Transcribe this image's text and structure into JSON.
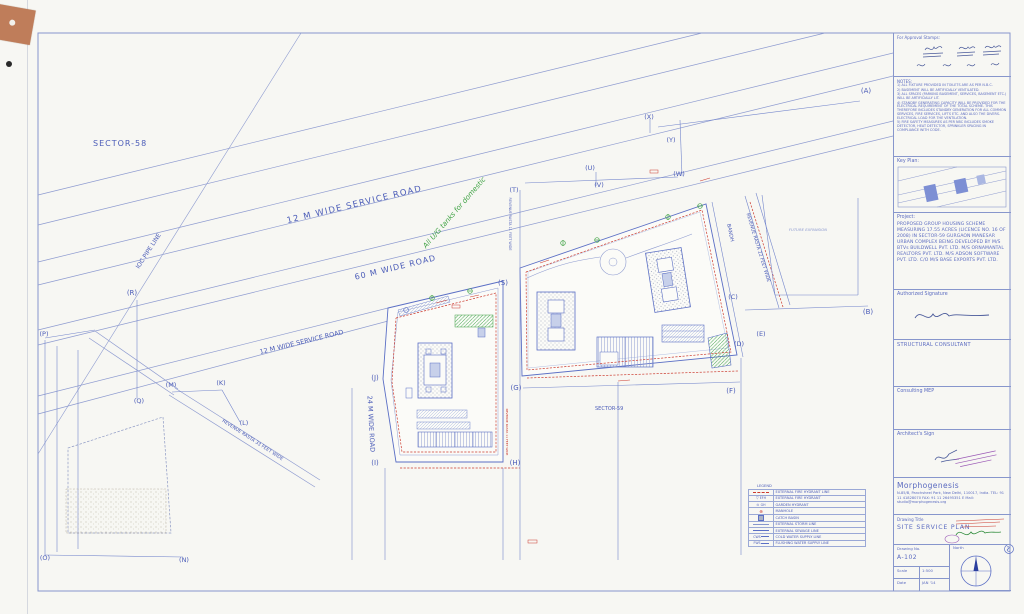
{
  "title_block": {
    "approval_label": "For Approval Stamps:",
    "notes": {
      "heading": "NOTES:",
      "items": [
        "1)  ALL FIXTURE PROVIDED IN TOILETS ARE AS PER N.B.C.",
        "2)  BASEMENT WILL BE ARTIFICIALLY VENTILATED.",
        "3)  ALL SPACES (PARKING BASEMENT, SERVICES, BASEMENT ETC.) WILL BE ARTIFICIALLY LIT.",
        "4)  STANDBY GENERATING CAPACITY WILL BE PROVIDED FOR THE ELECTRICAL REQUIREMENT OF THE TOTAL SCHEME. THIS THEREFORE INCLUDES STANDBY GENERATION FOR ALL COMMON SERVICES, FIRE SERVICES, LIFTS ETC. AND ALSO THE DIVERS. ELECTRICAL LOAD FOR THE VENTILATION.",
        "5)  FIRE SAFETY MEASURES AS PER NBC INCLUDES SMOKE DETECTOR, HEAT DETECTOR, SPRINKLER SPACING IN COMPLIANCE WITH CODE."
      ]
    },
    "key_plan_label": "Key Plan:",
    "project_heading": "Project:",
    "project_text": "PROPOSED GROUP HOUSING SCHEME MEASURING 17.55 ACRES (LICENCE NO. 16 OF 2008) IN SECTOR-59 GURGAON MANESAR URBAN COMPLEX BEING DEVELOPED BY M/S BTVs BUILDWELL PVT. LTD. M/S ORNAMANTAL REALTORS PVT. LTD. M/S ADSON SOFTWARE PVT. LTD. C/O M/S BASE EXPORTS PVT. LTD.",
    "authorized_signature_label": "Authorized Signature",
    "structural_consultant_label": "STRUCTURAL CONSULTANT",
    "consulting_mep_label": "Consulting MEP",
    "architects_sign_label": "Architect's Sign",
    "firm_name": "Morphogenesis",
    "firm_address": "N-85/B, Panchsheel Park, New Delhi, 110017, India. TEL: 91 11 41828070  FAX: 91 11 26495351  E Mail: studio@morphogenesis.org",
    "drawing_title_label": "Drawing Title",
    "drawing_title": "SITE SERVICE PLAN",
    "drawing_no_label": "Drawing No.",
    "drawing_no": "A-102",
    "north_label": "North",
    "scale_label": "Scale",
    "scale_value": "1:500",
    "date_label": "Date",
    "date_value": "JAN '14"
  },
  "legend": {
    "title": "LEGEND",
    "rows": [
      {
        "sym": "",
        "label": "EXTERNAL FIRE HYDRANT LINE"
      },
      {
        "sym": "EFH",
        "label": "EXTERNAL FIRE HYDRANT"
      },
      {
        "sym": "GH",
        "label": "GARDEN HYDRANT"
      },
      {
        "sym": "",
        "label": "MANHOLE"
      },
      {
        "sym": "",
        "label": "CATCH BASIN"
      },
      {
        "sym": "",
        "label": "EXTERNAL STORM LINE"
      },
      {
        "sym": "",
        "label": "EXTERNAL SEWAGE LINE"
      },
      {
        "sym": "CWS",
        "label": "COLD WATER SUPPLY LINE"
      },
      {
        "sym": "FWS",
        "label": "FLUSHING WATER SUPPLY LINE"
      }
    ]
  },
  "icons": {
    "efh_icon": "▽",
    "gh_icon": "⊙",
    "manhole_icon": "⊕",
    "catch_basin_icon": ""
  },
  "plan": {
    "labels": {
      "sector58": "SECTOR-58",
      "sector59": "SECTOR-59",
      "service_road_top": "12 M WIDE SERVICE ROAD",
      "road60": "60 M WIDE ROAD",
      "service_road_mid": "12 M WIDE SERVICE ROAD",
      "road24": "24 M WIDE ROAD",
      "ioc": "IOC PIPE LINE",
      "revenue22": "REVENUE RASTA 22 FEET WIDE",
      "revenue33": "REVENUE RASTA 33 FEET WIDE",
      "revenue11": "REVENUE RASTA 11 FEET WIDE",
      "revenue11_red": "REVENUE RASTA 11 FEET WIDE",
      "bandh": "BANDH",
      "future_expansion": "FUTURE EXPANSION",
      "green_note": "All U/G tanks for domestic"
    },
    "pts": {
      "A": "(A)",
      "B": "(B)",
      "C": "(C)",
      "D": "(D)",
      "E": "(E)",
      "F": "(F)",
      "G": "(G)",
      "H": "(H)",
      "I": "(I)",
      "J": "(J)",
      "K": "(K)",
      "L": "(L)",
      "M": "(M)",
      "N": "(N)",
      "O": "(O)",
      "P": "(P)",
      "Q": "(Q)",
      "R": "(R)",
      "S": "(S)",
      "T": "(T)",
      "U": "(U)",
      "V": "(V)",
      "W": "(W)",
      "X": "(X)",
      "Y": "(Y)"
    }
  },
  "colors": {
    "blueprint_line": "#8e9bd0",
    "blueprint_text": "#4b5cb8",
    "hydrant_red": "#cc3b2f",
    "landscape_green": "#3fa244",
    "stamp_purple": "#9b59b6",
    "tape_tan": "#bf7d5a"
  }
}
